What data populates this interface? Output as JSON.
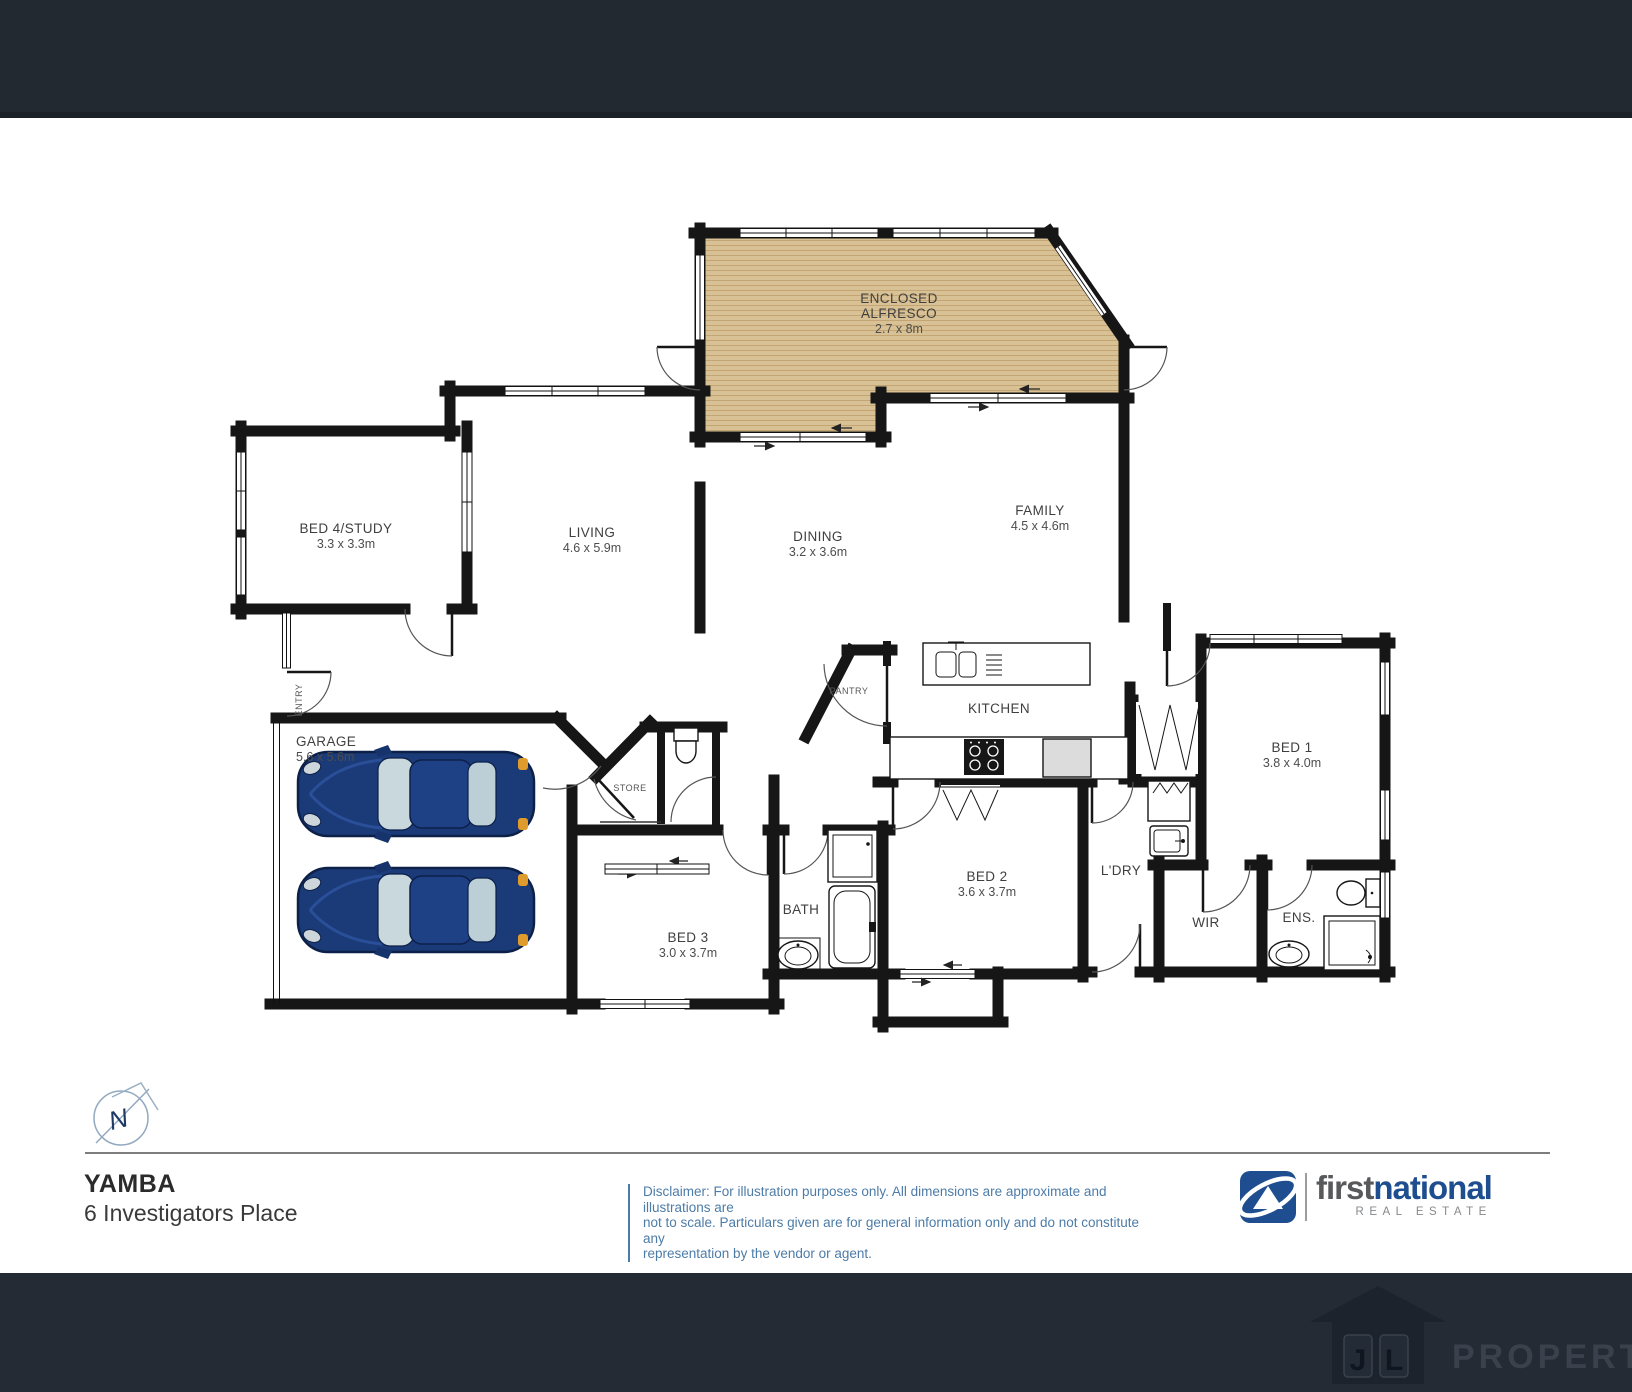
{
  "rooms": {
    "alfresco": {
      "line1": "ENCLOSED",
      "line2": "ALFRESCO",
      "dims": "2.7 x 8m"
    },
    "living": {
      "label": "LIVING",
      "dims": "4.6 x 5.9m"
    },
    "dining": {
      "label": "DINING",
      "dims": "3.2 x 3.6m"
    },
    "family": {
      "label": "FAMILY",
      "dims": "4.5 x 4.6m"
    },
    "bed4": {
      "label": "BED 4/STUDY",
      "dims": "3.3 x 3.3m"
    },
    "garage": {
      "label": "GARAGE",
      "dims": "5.6 x 5.6m"
    },
    "kitchen": {
      "label": "KITCHEN"
    },
    "pantry": {
      "label": "PANTRY"
    },
    "store": {
      "label": "STORE"
    },
    "entry": {
      "label": "ENTRY"
    },
    "bed1": {
      "label": "BED 1",
      "dims": "3.8 x 4.0m"
    },
    "bed2": {
      "label": "BED 2",
      "dims": "3.6 x 3.7m"
    },
    "bed3": {
      "label": "BED 3",
      "dims": "3.0 x 3.7m"
    },
    "bath": {
      "label": "BATH"
    },
    "laundry": {
      "label": "L'DRY"
    },
    "wir": {
      "label": "WIR"
    },
    "ens": {
      "label": "ENS."
    }
  },
  "compass": {
    "letter": "N"
  },
  "footer": {
    "suburb": "YAMBA",
    "address": "6 Investigators Place",
    "disclaimer_line1": "Disclaimer: For illustration purposes only. All dimensions are approximate and illustrations are",
    "disclaimer_line2": "not to scale. Particulars given are for general information only and do not constitute any",
    "disclaimer_line3": "representation by the vendor or agent."
  },
  "brand": {
    "first": "first",
    "national": "national",
    "tagline": "REAL ESTATE"
  },
  "watermark": {
    "initials": "JL",
    "name": "PROPERTY"
  },
  "colors": {
    "header_bg": "#232931",
    "footer_bg": "#242b34",
    "wall": "#161616",
    "deck_wood": "#d8c194",
    "logo_blue": "#1e4e8f",
    "disclaimer_blue": "#4d7ca8",
    "car_blue": "#1a3a78"
  }
}
